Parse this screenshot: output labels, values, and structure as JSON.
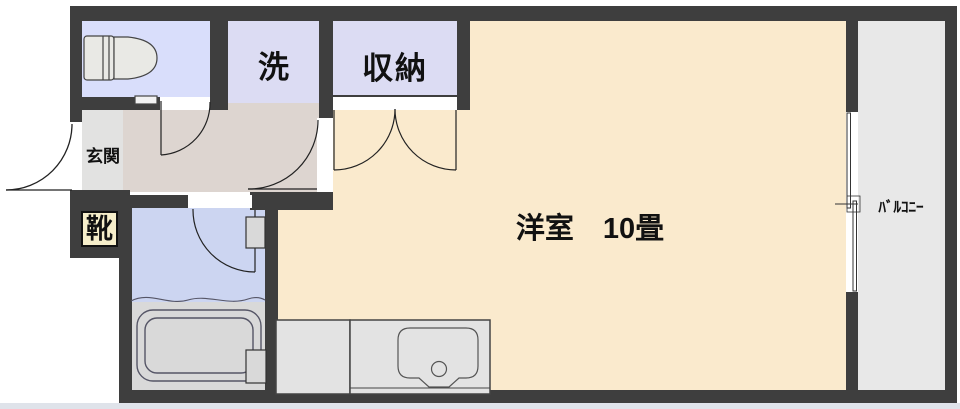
{
  "rooms": {
    "entrance": {
      "label": "玄関"
    },
    "laundry": {
      "label": "洗"
    },
    "storage": {
      "label": "収納"
    },
    "shoe_cabinet": {
      "label": "靴"
    },
    "western_room": {
      "label": "洋室　10畳"
    },
    "balcony": {
      "label": "ﾊﾞﾙｺﾆｰ"
    }
  },
  "fixtures": [
    "toilet-icon",
    "bathtub-icon",
    "kitchen-sink-icon",
    "kitchen-counter",
    "sliding-window-icon",
    "entrance-door-swing",
    "toilet-door-swing",
    "room-door-swing",
    "storage-double-door-swing",
    "bathroom-door-swing"
  ],
  "colors": {
    "wall": "#3e3e3e",
    "toilet_room": "#d9defb",
    "laundry_storage": "#dcdcf3",
    "hallway": "#ddd5d0",
    "entrance_floor": "#e2e2e1",
    "main_room": "#faeacd",
    "balcony": "#e8e8e8",
    "bathroom_upper": "#ccd5f1",
    "bathroom_lower": "#d9d9d9",
    "counter": "#e3e3e3",
    "shoe_box": "#f6eeca"
  }
}
